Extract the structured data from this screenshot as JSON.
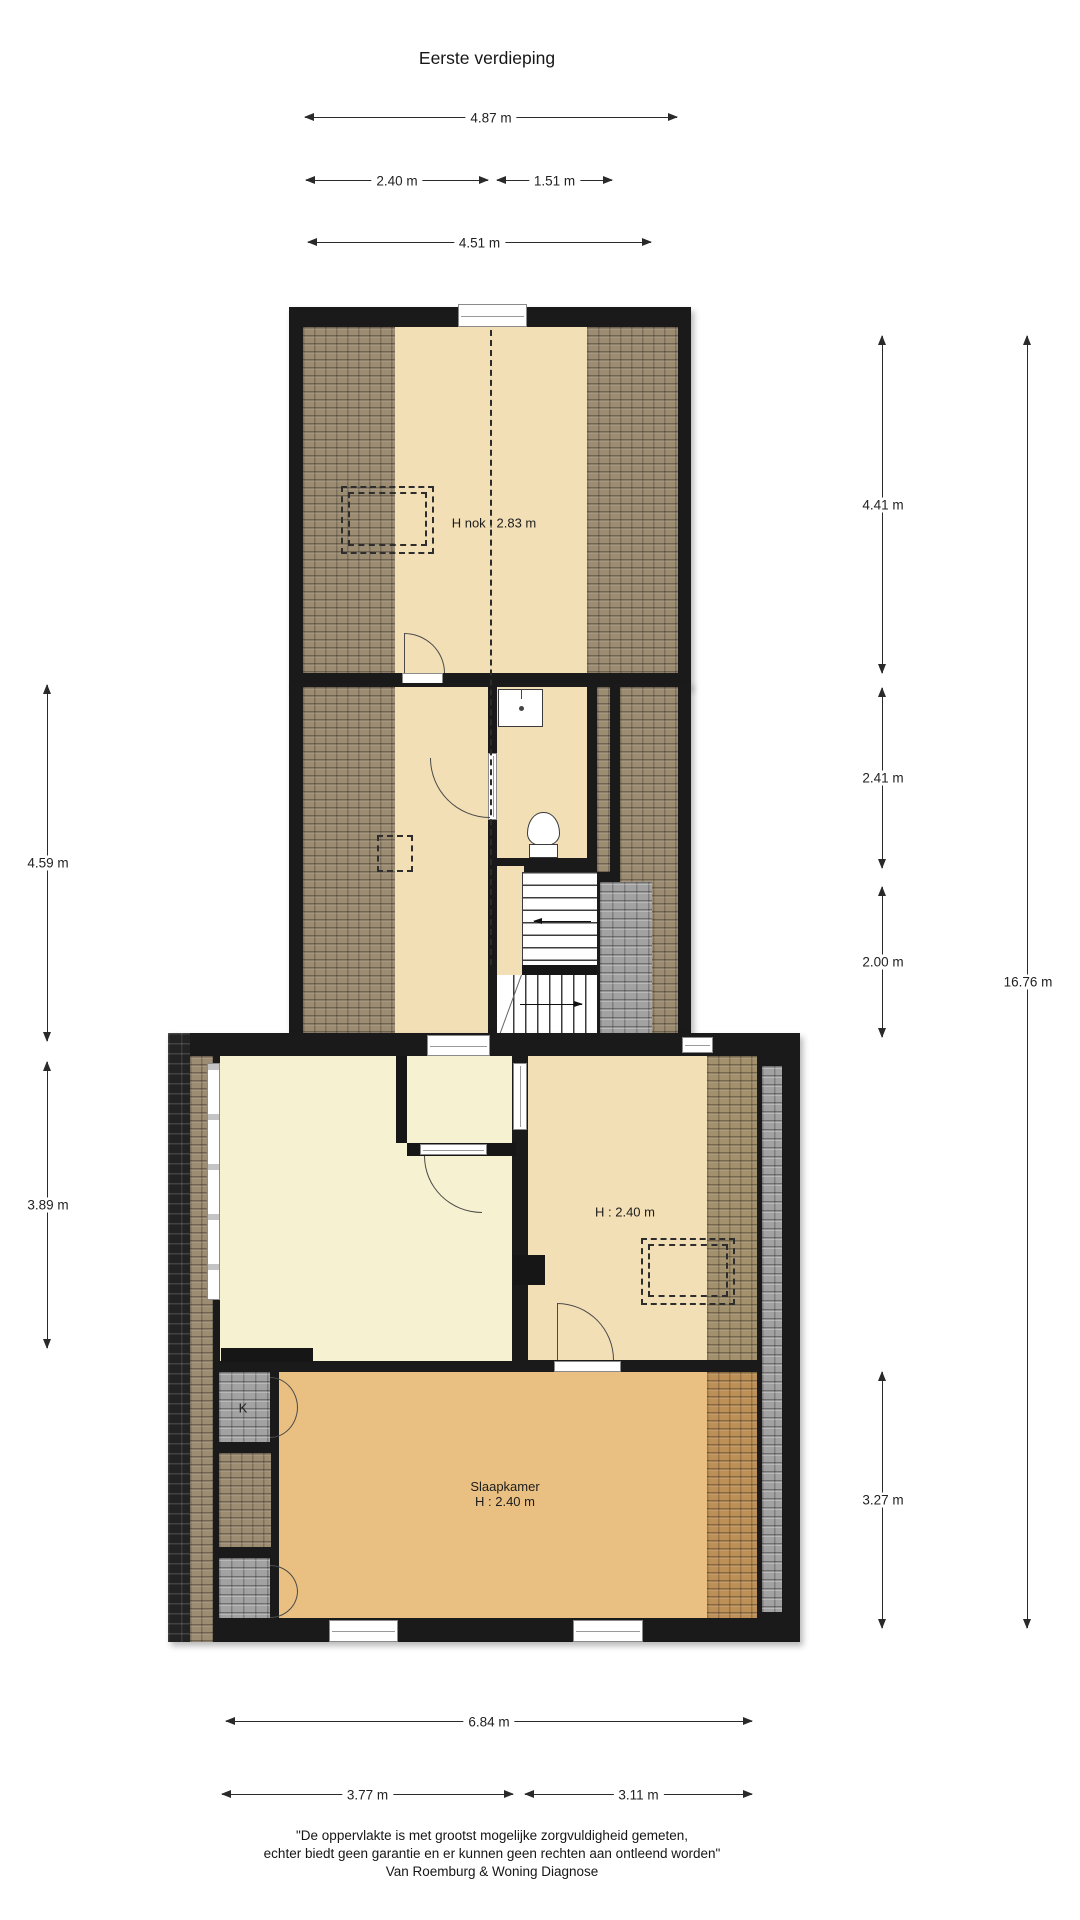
{
  "title": "Eerste verdieping",
  "dims": {
    "top_overall": "4.87 m",
    "top_left_seg": "2.40 m",
    "top_right_seg": "1.51 m",
    "top_inner": "4.51 m",
    "left_middle": "4.59 m",
    "left_lower": "3.89 m",
    "right_attic": "4.41 m",
    "right_landing": "2.41 m",
    "right_stairs": "2.00 m",
    "right_bedroom": "3.27 m",
    "right_total": "16.76 m",
    "bottom_overall": "6.84 m",
    "bottom_left_seg": "3.77 m",
    "bottom_right_seg": "3.11 m"
  },
  "rooms": {
    "attic_height_label": "H nok : 2.83 m",
    "right_room_height_label": "H : 2.40 m",
    "bedroom_name": "Slaapkamer",
    "bedroom_height_label": "H : 2.40 m",
    "closet_label": "K"
  },
  "disclaimer": {
    "line1": "\"De oppervlakte is met grootst mogelijke zorgvuldigheid gemeten,",
    "line2": "echter biedt geen garantie en er kunnen geen rechten aan ontleend worden\"",
    "line3": "Van Roemburg & Woning Diagnose"
  },
  "colors": {
    "floor_cream": "#f3dfb6",
    "floor_yellow": "#f6f2d1",
    "floor_bedroom": "#e9c081",
    "roof_brown": "#9c8c72",
    "roof_dark": "#232323",
    "roof_gray": "#a2a2a2",
    "wall": "#161616",
    "dimension_line": "#2a2a2a"
  }
}
